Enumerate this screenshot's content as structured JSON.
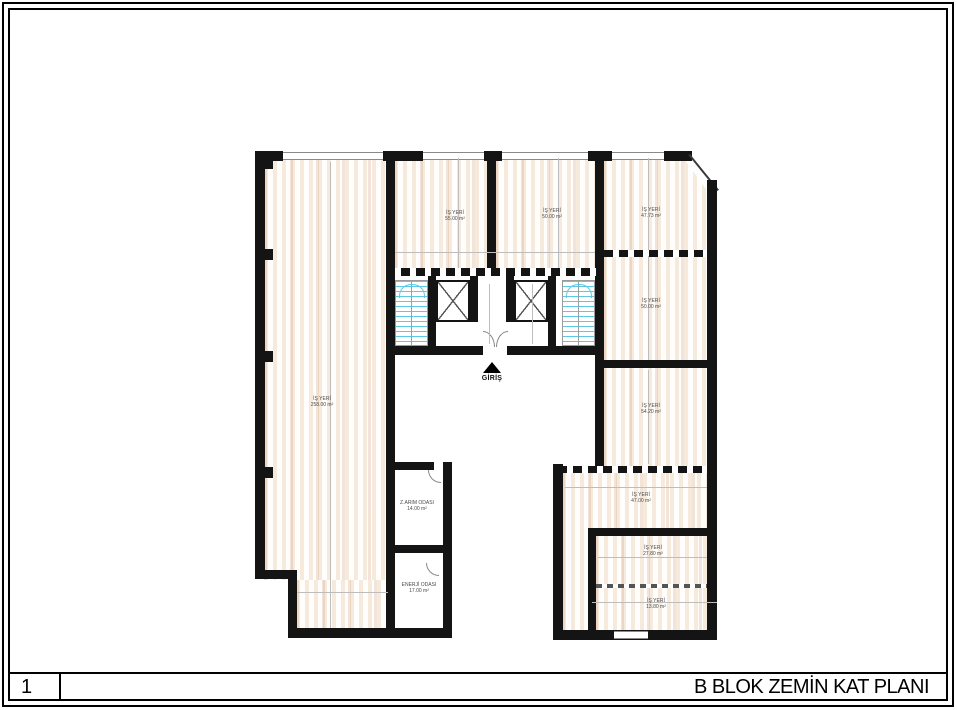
{
  "sheet": {
    "number": "1",
    "title": "B BLOK ZEMİN KAT PLANI"
  },
  "plan": {
    "entrance_label": "GİRİŞ",
    "rooms": [
      {
        "id": "shop-left",
        "name": "İŞ YERİ",
        "area": "258.00 m²"
      },
      {
        "id": "shop-top-1",
        "name": "İŞ YERİ",
        "area": "55.00 m²"
      },
      {
        "id": "shop-top-2",
        "name": "İŞ YERİ",
        "area": "50.00 m²"
      },
      {
        "id": "shop-top-right",
        "name": "İŞ YERİ",
        "area": "47.73 m²"
      },
      {
        "id": "shop-right-1",
        "name": "İŞ YERİ",
        "area": "50.00 m²"
      },
      {
        "id": "shop-right-2",
        "name": "İŞ YERİ",
        "area": "54.20 m²"
      },
      {
        "id": "shop-br-1",
        "name": "İŞ YERİ",
        "area": "47.00 m²"
      },
      {
        "id": "shop-br-2",
        "name": "İŞ YERİ",
        "area": "27.80 m²"
      },
      {
        "id": "shop-br-3",
        "name": "İŞ YERİ",
        "area": "13.80 m²"
      },
      {
        "id": "tech-1",
        "name": "Z.ARIM ODASI",
        "area": "14.00 m²"
      },
      {
        "id": "tech-2",
        "name": "ENERJİ ODASI",
        "area": "17.00 m²"
      }
    ],
    "colors": {
      "wall": "#141414",
      "floor_hatch": "#f6eadd",
      "stair": "#5bc9e6"
    }
  }
}
